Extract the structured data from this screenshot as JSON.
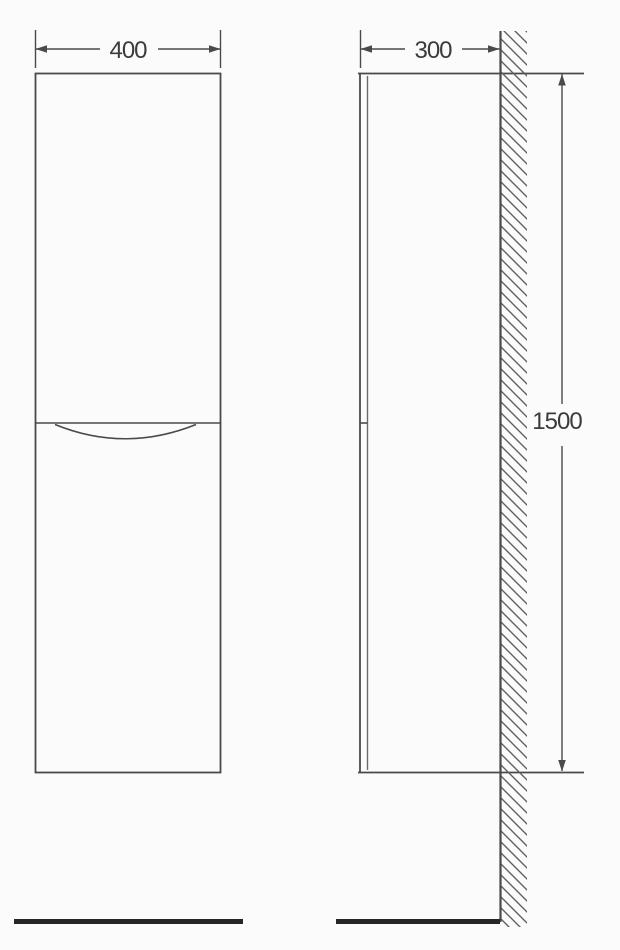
{
  "dimensions": {
    "width_mm": "400",
    "depth_mm": "300",
    "height_mm": "1500"
  },
  "colors": {
    "bg": "#fbfbfb",
    "line": "#4a4a4a",
    "thin": "#6a6a6a",
    "hatch": "#5f5f5f",
    "floor": "#262626",
    "text": "#3b3b3b"
  }
}
